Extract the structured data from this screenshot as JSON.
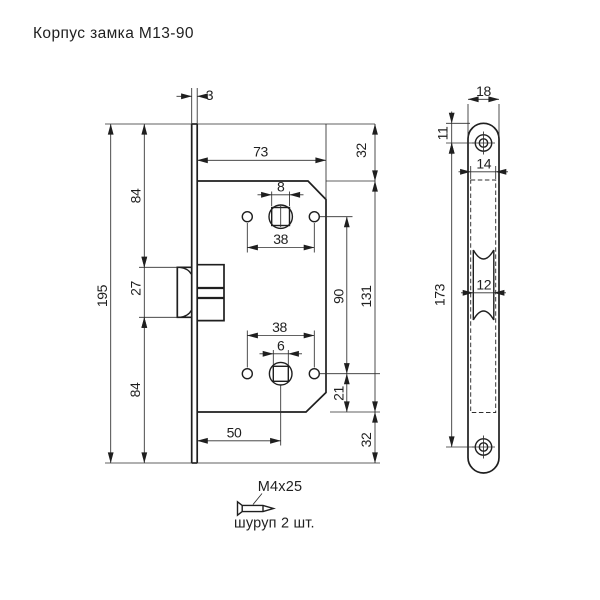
{
  "title": "Корпус замка М13-90",
  "main_view": {
    "dims": {
      "plate_thickness": "3",
      "body_width": "73",
      "top_offset": "32",
      "upper_height": "84",
      "square_top": "8",
      "holes_span_top": "38",
      "latch_height": "27",
      "total_height": "195",
      "centers_distance": "90",
      "body_height": "131",
      "holes_span_bottom": "38",
      "square_bottom": "6",
      "lower_offset": "21",
      "lower_height": "84",
      "backset": "50",
      "bottom_offset": "32"
    }
  },
  "faceplate_view": {
    "dims": {
      "plate_width": "18",
      "screw_top_offset": "11",
      "hidden_body_width": "14",
      "latch_slot_width": "12",
      "screw_centers": "173"
    }
  },
  "screw_note": {
    "size": "М4х25",
    "quantity": "шуруп 2 шт."
  },
  "colors": {
    "line": "#1f1f1f",
    "background": "#ffffff"
  }
}
